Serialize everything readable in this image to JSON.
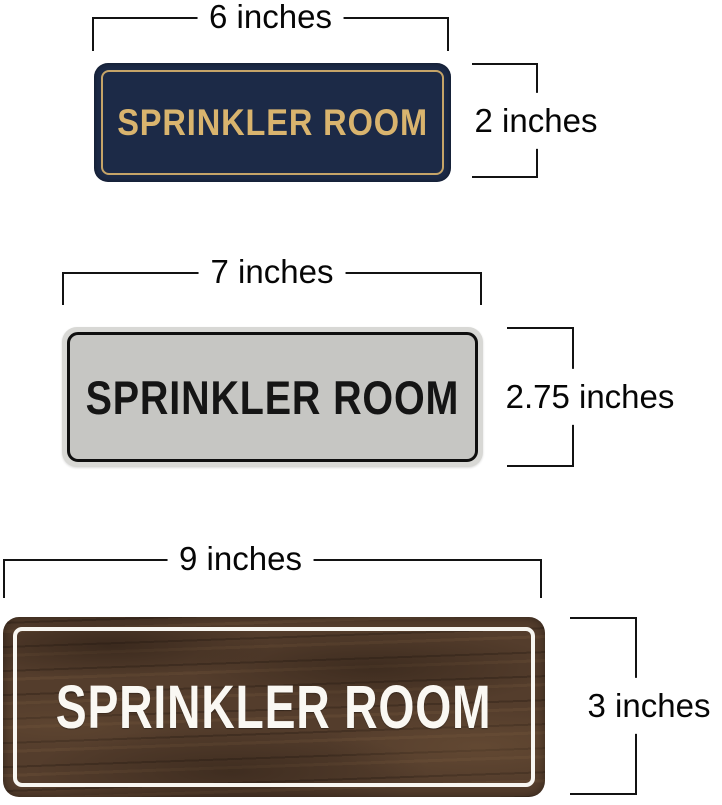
{
  "dimension_line_color": "#131313",
  "signs": [
    {
      "style": "navy-gold",
      "title": "SPRINKLER ROOM",
      "width_label": "6 inches",
      "height_label": "2 inches",
      "face_color": "#1c2a47",
      "border_color": "#c5a468",
      "text_color": "#d9b46e"
    },
    {
      "style": "brushed-silver",
      "title": "SPRINKLER ROOM",
      "width_label": "7 inches",
      "height_label": "2.75 inches",
      "face_color": "#c6c6c3",
      "border_color": "#0f0f0f",
      "text_color": "#151515"
    },
    {
      "style": "walnut-wood",
      "title": "SPRINKLER ROOM",
      "width_label": "9 inches",
      "height_label": "3 inches",
      "face_color": "#543d2c",
      "border_color": "#f8f6f1",
      "text_color": "#faf8f3"
    }
  ]
}
